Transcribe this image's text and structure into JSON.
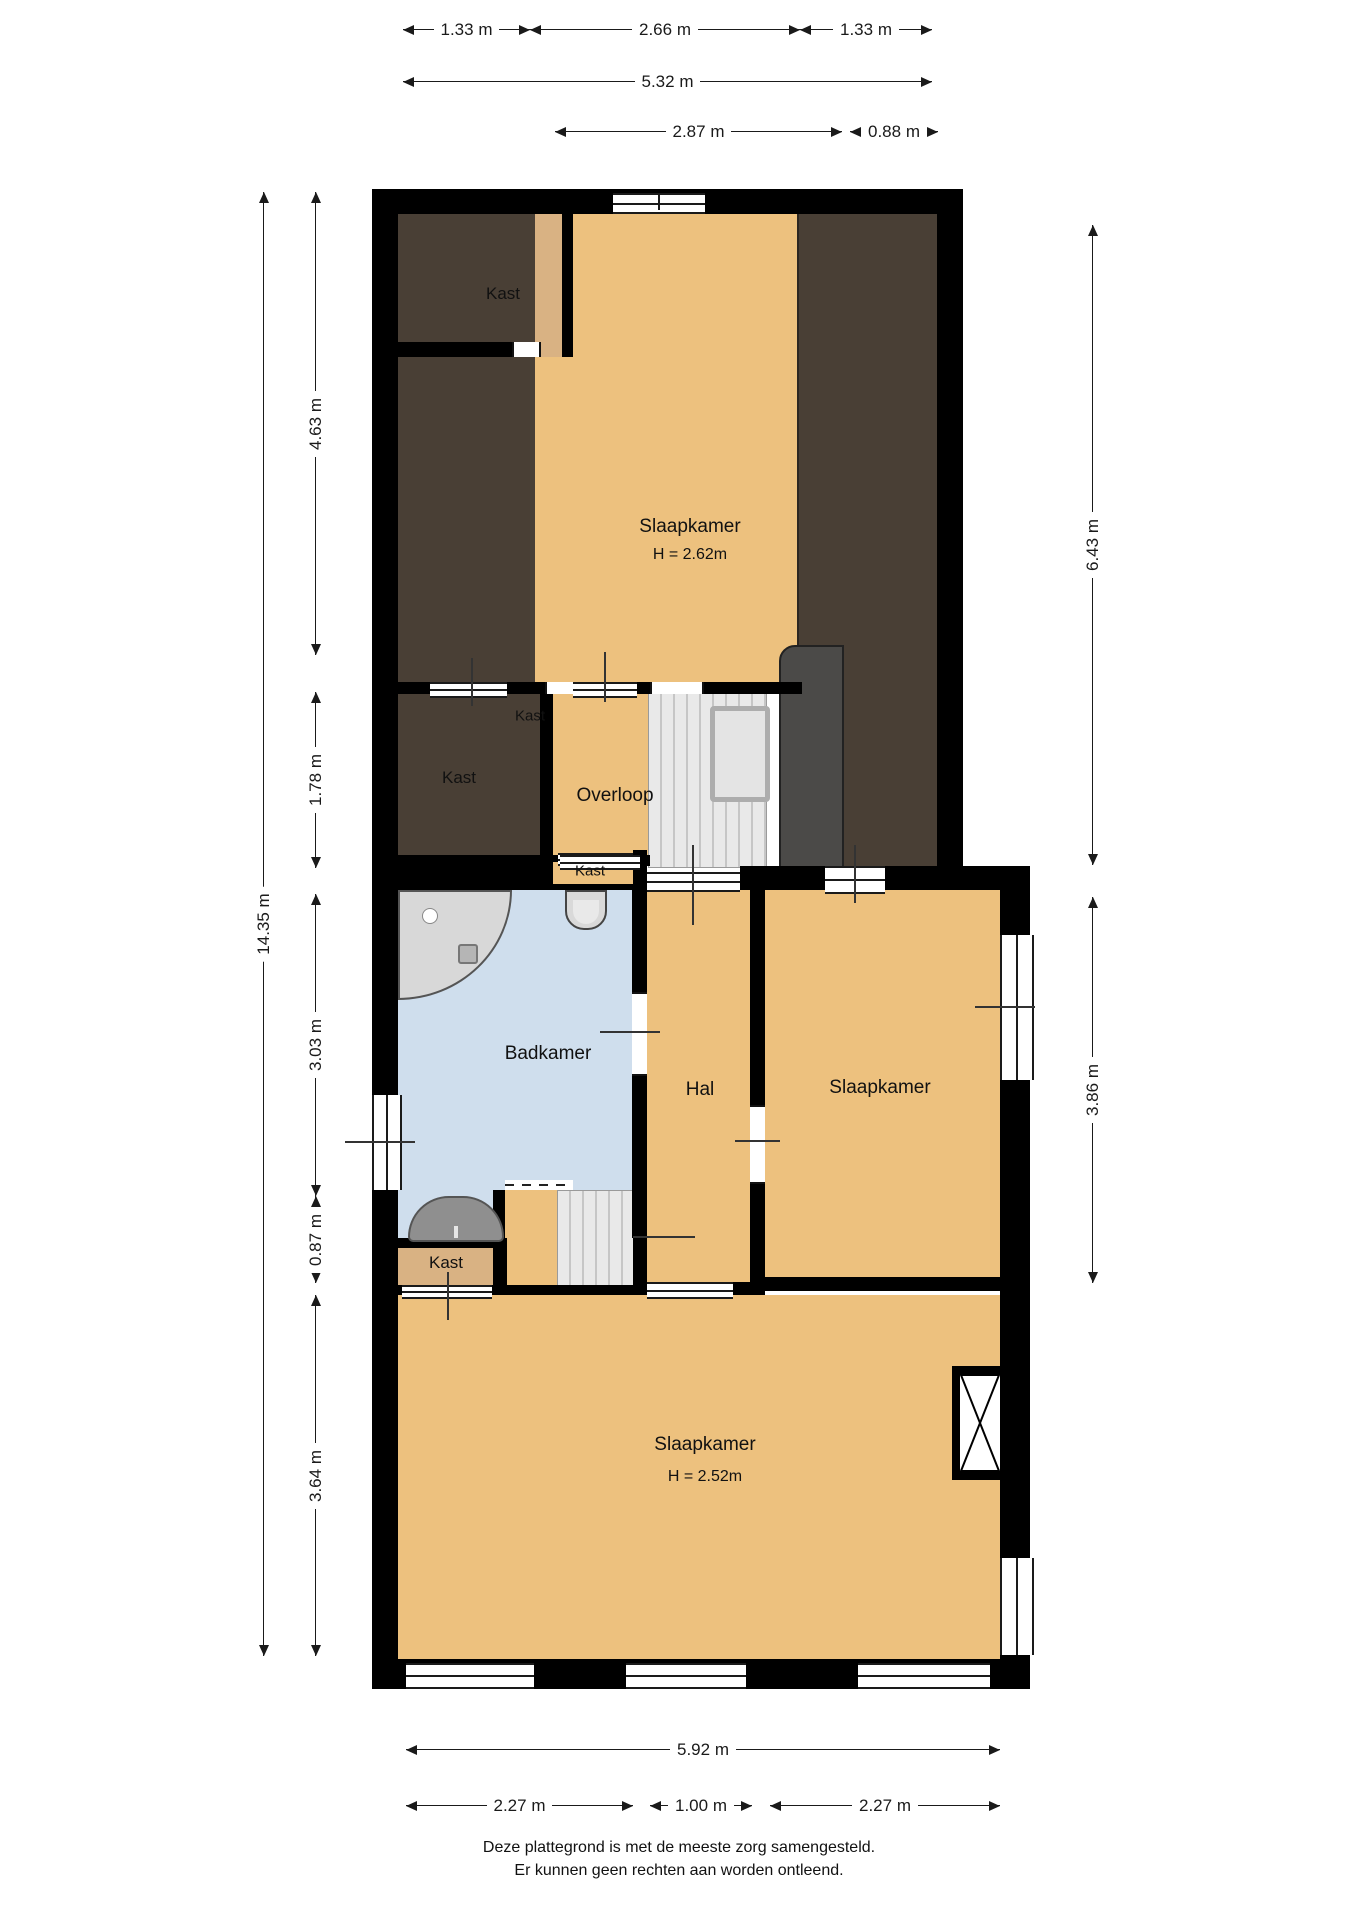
{
  "palette": {
    "wall": "#000000",
    "floor_orange": "#edc17e",
    "floor_tan": "#d9b283",
    "sloped_attic_brown": "#493f35",
    "chimney_gray": "#4b4a48",
    "bathroom_blue": "#cfdeed",
    "stair_gray": "#e9e9e9",
    "dimension_ink": "#1a1a1a"
  },
  "rooms": {
    "kast_attic": "Kast",
    "slaapkamer_attic": {
      "name": "Slaapkamer",
      "height": "H = 2.62m"
    },
    "kast_mid_small": "Kast",
    "kast_mid": "Kast",
    "overloop": "Overloop",
    "kast_hal": "Kast",
    "badkamer": "Badkamer",
    "hal": "Hal",
    "slaapkamer_right": "Slaapkamer",
    "kast_bottom": "Kast",
    "slaapkamer_bottom": {
      "name": "Slaapkamer",
      "height": "H = 2.52m"
    }
  },
  "dimensions": {
    "top_row1": [
      "1.33 m",
      "2.66 m",
      "1.33 m"
    ],
    "top_row2": "5.32 m",
    "top_row3": [
      "2.87 m",
      "0.88 m"
    ],
    "left_outer": "14.35 m",
    "left_inner": [
      "4.63 m",
      "1.78 m",
      "3.03 m",
      "0.87 m",
      "3.64 m"
    ],
    "right": [
      "6.43 m",
      "3.86 m"
    ],
    "bottom_row1": "5.92 m",
    "bottom_row2": [
      "2.27 m",
      "1.00 m",
      "2.27 m"
    ]
  },
  "symbols": {
    "stairs": "tread-lines",
    "shower": "quarter-circle",
    "toilet": "u-shape",
    "sink": "half-oval",
    "chimney": "bowtie-in-box",
    "window": "triple-line",
    "railing": "bordered-box"
  },
  "footer": {
    "line1": "Deze plattegrond is met de meeste zorg samengesteld.",
    "line2": "Er kunnen geen rechten aan worden ontleend."
  }
}
